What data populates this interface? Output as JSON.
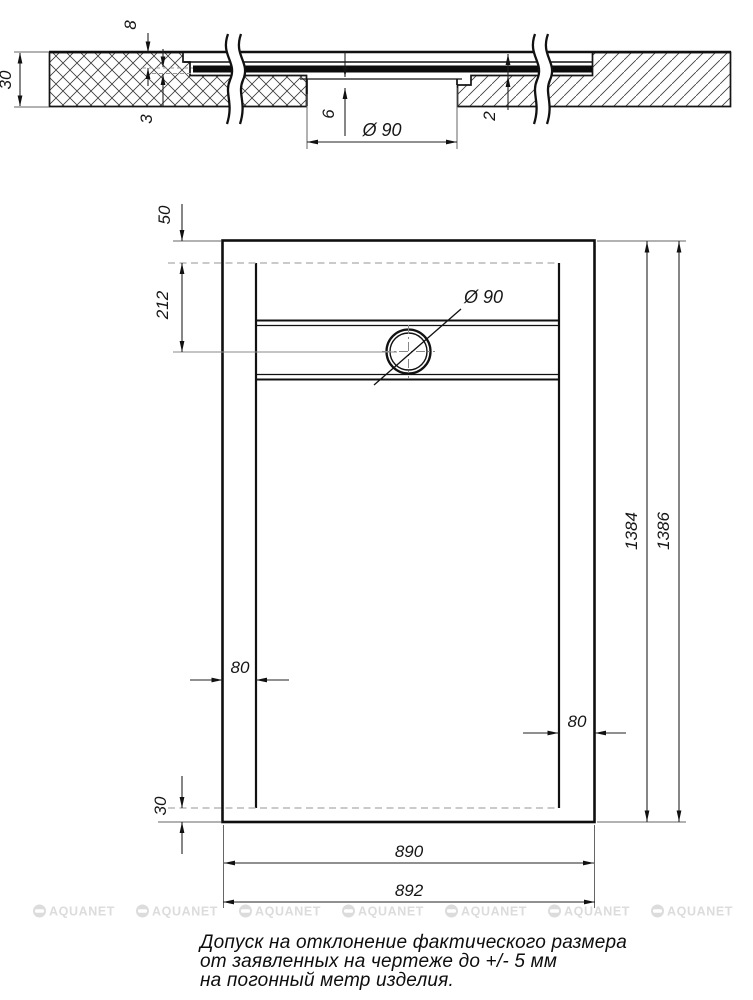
{
  "drawing_type": "shower-tray-technical-drawing",
  "section_view": {
    "dims": {
      "total_thickness": "30",
      "channel_depth": "8",
      "sheet_thickness": "3",
      "recess_height": "6",
      "drain_diameter": "Ø 90",
      "edge_step": "2"
    }
  },
  "plan_view": {
    "dims": {
      "top_offset": "50",
      "drain_center_offset": "212",
      "drain_diameter": "Ø 90",
      "inner_length": "1384",
      "outer_length": "1386",
      "left_margin": "80",
      "right_margin": "80",
      "bottom_offset": "30",
      "inner_width": "890",
      "outer_width": "892"
    }
  },
  "footer": {
    "tolerance_note_line1": "Допуск на отклонение фактического размера",
    "tolerance_note_line2": "от заявленных на чертеже до +/- 5 мм",
    "tolerance_note_line3": "на погонный метр изделия."
  },
  "watermark": {
    "label": "AQUANET",
    "count": 7,
    "spacing": 103,
    "start_x": 33,
    "row_y": 911,
    "color": "#dcdcdc"
  },
  "colors": {
    "line": "#111111",
    "dim_line": "#222222",
    "hidden_line": "#b9b9b9",
    "extension_line": "#666666",
    "watermark": "#dcdcdc"
  }
}
